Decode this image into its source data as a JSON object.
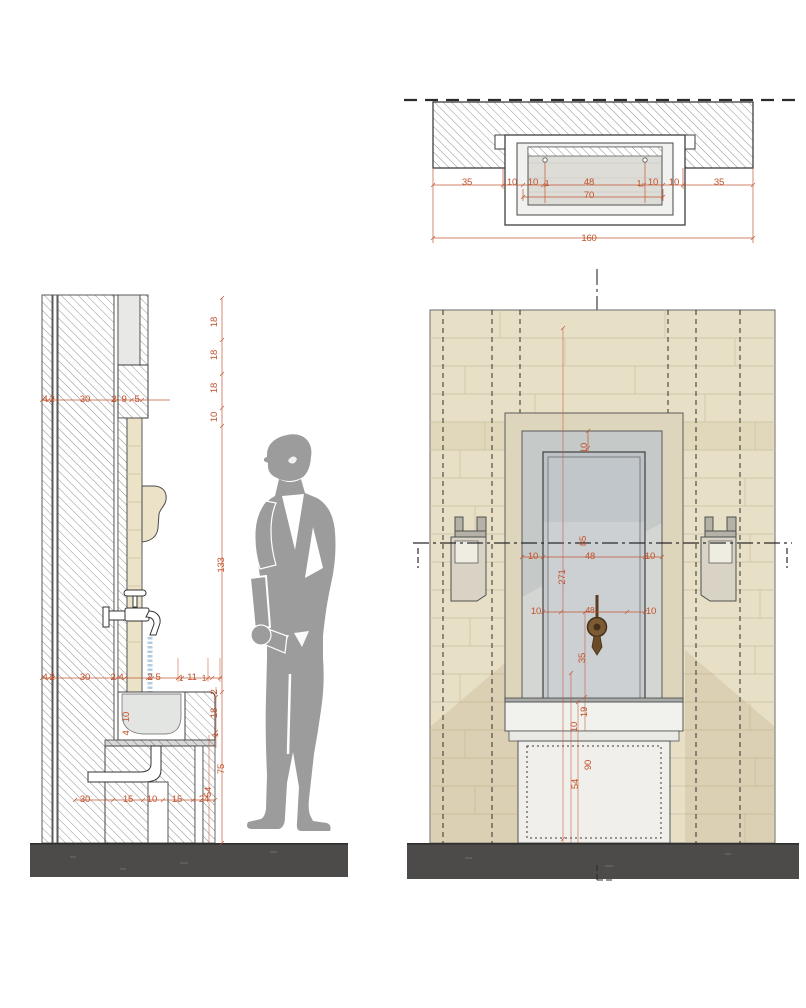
{
  "colors": {
    "dimension_text": "#c0512b",
    "stone_beige": "#e8e0c6",
    "recess_gray": "#d4d6d3",
    "figure_gray": "#9c9c9c",
    "plinth_dark": "#4c4b49",
    "water_blue": "#aac8de",
    "tap_brown": "#7b5a34"
  },
  "plan": {
    "dims": [
      "35",
      "10",
      "10",
      "1",
      "48",
      "1",
      "10",
      "10",
      "35"
    ],
    "inner_width": "70",
    "total_width": "160"
  },
  "section": {
    "top_heights": [
      "18",
      "18",
      "18",
      "10"
    ],
    "wall_upper": [
      "4",
      "2",
      "30",
      "2",
      "9",
      "5"
    ],
    "niche_height": "133",
    "wall_lower": [
      "4",
      "2",
      "30",
      "2",
      "4",
      "2",
      "5",
      "1",
      "11",
      "1"
    ],
    "basin_inner": [
      "10",
      "4"
    ],
    "rim_heights": [
      "2",
      "18",
      "1"
    ],
    "pedestal_heights": [
      "75",
      "54"
    ],
    "base_widths": [
      "30",
      "15",
      "10",
      "15",
      "24"
    ]
  },
  "elevation": {
    "panel_top": "10",
    "level_height": "85",
    "opening": [
      "10",
      "48",
      "10"
    ],
    "total_height": "271",
    "tap_row": [
      "10",
      "48",
      "10"
    ],
    "tap_to_basin": "35",
    "basin_front": "19",
    "ledge": "10",
    "pedestal_upper": "90",
    "plinth_height": "54"
  }
}
